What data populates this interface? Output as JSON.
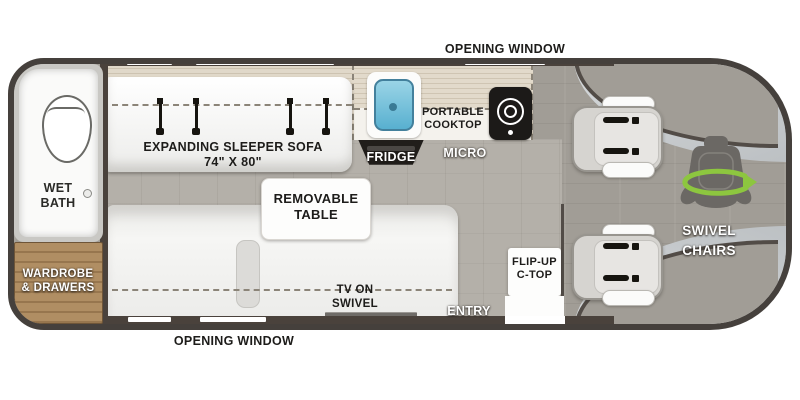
{
  "floorplan": {
    "windows": {
      "top_label": "OPENING WINDOW",
      "bottom_label": "OPENING WINDOW"
    },
    "rear": {
      "wet_bath": [
        "WET",
        "BATH"
      ],
      "wardrobe": [
        "WARDROBE",
        "& DRAWERS"
      ]
    },
    "lounge": {
      "sofa": [
        "EXPANDING SLEEPER SOFA",
        "74\" X 80\""
      ],
      "table": [
        "REMOVABLE",
        "TABLE"
      ],
      "tv": [
        "TV ON",
        "SWIVEL"
      ]
    },
    "galley": {
      "cooktop": [
        "PORTABLE",
        "COOKTOP"
      ],
      "fridge": "FRIDGE",
      "micro": "MICRO",
      "flip_up": [
        "FLIP-UP",
        "C-TOP"
      ],
      "entry": "ENTRY"
    },
    "cab": {
      "swivel": [
        "SWIVEL",
        "CHAIRS"
      ]
    },
    "colors": {
      "body_outline": "#45403c",
      "wall": "#4a423c",
      "galley_floor": "#b4b0a9",
      "cab_floor": "#a19d96",
      "windshield_silver": "#c9ccce",
      "wood": "#a8875f",
      "counter": "#ddd5c6",
      "sofa_white": "#f3f3f0",
      "sink_blue": "#7cc3dc",
      "appliance_black": "#1c1a18",
      "seat_gray": "#d6d4d0",
      "swivel_green": "#8dc63f"
    }
  }
}
